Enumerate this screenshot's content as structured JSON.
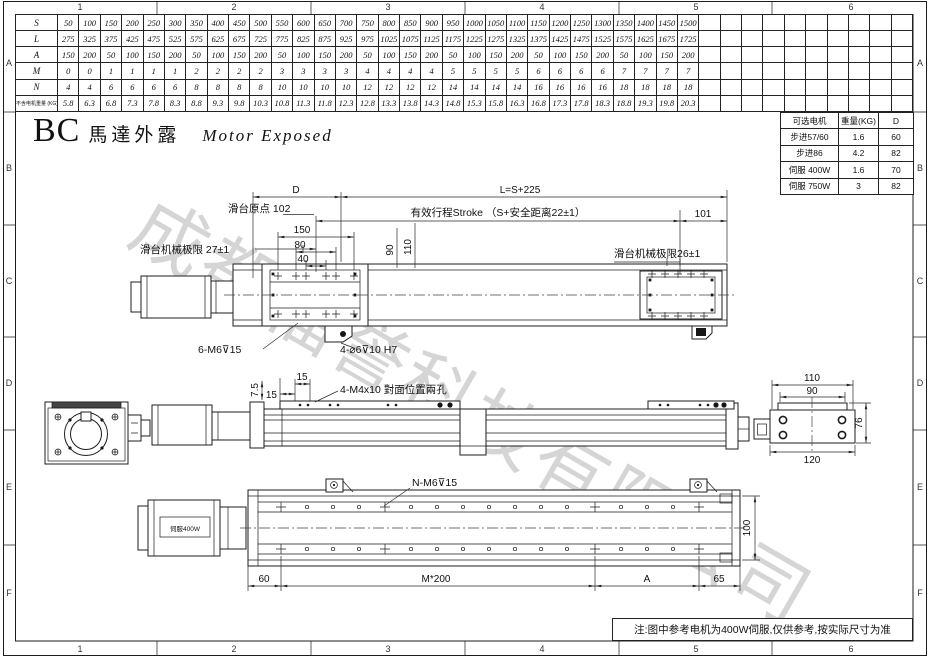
{
  "frame": {
    "zones_top": [
      "1",
      "2",
      "3",
      "4",
      "5",
      "6"
    ],
    "zones_bottom": [
      "1",
      "2",
      "3",
      "4",
      "5",
      "6"
    ],
    "zones_left": [
      "A",
      "B",
      "C",
      "D",
      "E",
      "F"
    ],
    "zones_right": [
      "A",
      "B",
      "C",
      "D",
      "E",
      "F"
    ]
  },
  "title": {
    "code": "BC",
    "name_cn": "馬達外露",
    "name_en": "Motor Exposed"
  },
  "spec_table": {
    "empty_columns": 10,
    "rows": [
      {
        "label": "S",
        "values": [
          "50",
          "100",
          "150",
          "200",
          "250",
          "300",
          "350",
          "400",
          "450",
          "500",
          "550",
          "600",
          "650",
          "700",
          "750",
          "800",
          "850",
          "900",
          "950",
          "1000",
          "1050",
          "1100",
          "1150",
          "1200",
          "1250",
          "1300",
          "1350",
          "1400",
          "1450",
          "1500"
        ]
      },
      {
        "label": "L",
        "values": [
          "275",
          "325",
          "375",
          "425",
          "475",
          "525",
          "575",
          "625",
          "675",
          "725",
          "775",
          "825",
          "875",
          "925",
          "975",
          "1025",
          "1075",
          "1125",
          "1175",
          "1225",
          "1275",
          "1325",
          "1375",
          "1425",
          "1475",
          "1525",
          "1575",
          "1625",
          "1675",
          "1725"
        ]
      },
      {
        "label": "A",
        "values": [
          "150",
          "200",
          "50",
          "100",
          "150",
          "200",
          "50",
          "100",
          "150",
          "200",
          "50",
          "100",
          "150",
          "200",
          "50",
          "100",
          "150",
          "200",
          "50",
          "100",
          "150",
          "200",
          "50",
          "100",
          "150",
          "200",
          "50",
          "100",
          "150",
          "200"
        ]
      },
      {
        "label": "M",
        "values": [
          "0",
          "0",
          "1",
          "1",
          "1",
          "1",
          "2",
          "2",
          "2",
          "2",
          "3",
          "3",
          "3",
          "3",
          "4",
          "4",
          "4",
          "4",
          "5",
          "5",
          "5",
          "5",
          "6",
          "6",
          "6",
          "6",
          "7",
          "7",
          "7",
          "7"
        ]
      },
      {
        "label": "N",
        "values": [
          "4",
          "4",
          "6",
          "6",
          "6",
          "6",
          "8",
          "8",
          "8",
          "8",
          "10",
          "10",
          "10",
          "10",
          "12",
          "12",
          "12",
          "12",
          "14",
          "14",
          "14",
          "14",
          "16",
          "16",
          "16",
          "16",
          "18",
          "18",
          "18",
          "18"
        ]
      },
      {
        "label": "不含电机重量 (KG)",
        "values": [
          "5.8",
          "6.3",
          "6.8",
          "7.3",
          "7.8",
          "8.3",
          "8.8",
          "9.3",
          "9.8",
          "10.3",
          "10.8",
          "11.3",
          "11.8",
          "12.3",
          "12.8",
          "13.3",
          "13.8",
          "14.3",
          "14.8",
          "15.3",
          "15.8",
          "16.3",
          "16.8",
          "17.3",
          "17.8",
          "18.3",
          "18.8",
          "19.3",
          "19.8",
          "20.3"
        ]
      }
    ]
  },
  "motor_table": {
    "headers": [
      "可选电机",
      "重量(KG)",
      "D"
    ],
    "rows": [
      [
        "步进57/60",
        "1.6",
        "60"
      ],
      [
        "步进86",
        "4.2",
        "82"
      ],
      [
        "伺服 400W",
        "1.6",
        "70"
      ],
      [
        "伺服 750W",
        "3",
        "82"
      ]
    ]
  },
  "views": {
    "top": {
      "d": "D",
      "l": "L=S+225",
      "origin": "滑台原点 102",
      "stroke": "有效行程Stroke （S+安全距离22±1）",
      "n101": "101",
      "d150": "150",
      "d80": "80",
      "d40": "40",
      "d90": "90",
      "d110": "110",
      "limit_left": "滑台机械极限 27±1",
      "limit_right": "滑台机械极限26±1",
      "holes_m6": "6-M6⊽15",
      "holes_pin": "4-⌀6⊽10 H7"
    },
    "front": {
      "d75": "7.5",
      "d15a": "15",
      "d15b": "15",
      "holes": "4-M4x10 對面位置兩孔"
    },
    "end": {
      "d110": "110",
      "d90": "90",
      "d76": "76",
      "d120": "120"
    },
    "bottom": {
      "holes": "N-M6⊽15",
      "motor": "伺服400W",
      "d60": "60",
      "dm": "M*200",
      "da": "A",
      "d65": "65",
      "d100": "100"
    }
  },
  "watermark": "成都福誉科技有限公司",
  "note": "注:图中参考电机为400W伺服,仅供参考,按实际尺寸为准"
}
